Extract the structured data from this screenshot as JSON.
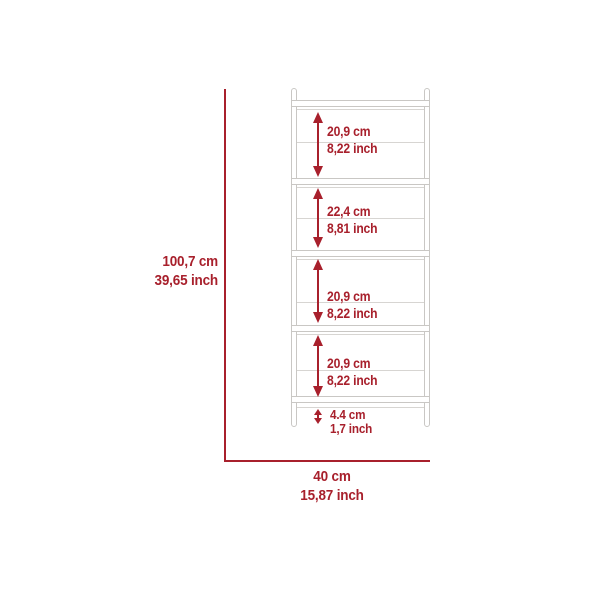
{
  "diagram": {
    "type": "furniture-dimension-diagram",
    "product": "5-tier ladder bookshelf",
    "colors": {
      "dimension_red": "#A8202C",
      "outline_gray": "#C9C7C4",
      "background": "#FFFFFF"
    },
    "overall_height": {
      "cm": "100,7 cm",
      "inch": "39,65 inch"
    },
    "overall_width": {
      "cm": "40 cm",
      "inch": "15,87 inch"
    },
    "sections": [
      {
        "name": "shelf-opening-1",
        "cm": "20,9 cm",
        "inch": "8,22 inch"
      },
      {
        "name": "shelf-opening-2",
        "cm": "22,4 cm",
        "inch": "8,81 inch"
      },
      {
        "name": "shelf-opening-3",
        "cm": "20,9 cm",
        "inch": "8,22 inch"
      },
      {
        "name": "shelf-opening-4",
        "cm": "20,9 cm",
        "inch": "8,22 inch"
      },
      {
        "name": "base-clearance",
        "cm": "4.4 cm",
        "inch": "1,7 inch"
      }
    ]
  }
}
